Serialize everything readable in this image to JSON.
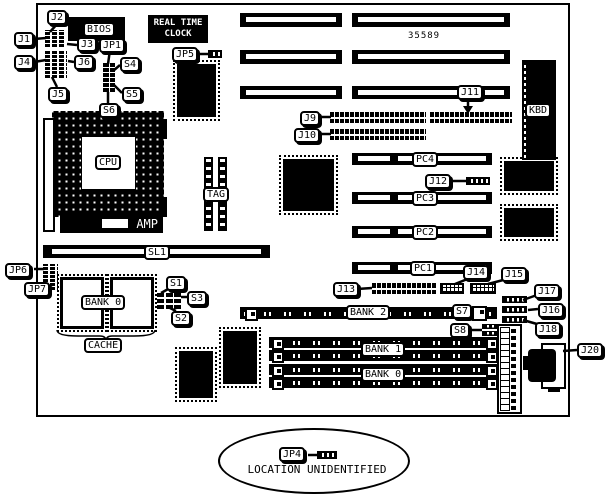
{
  "diagram": {
    "part_number": "35589",
    "rtc": {
      "line1": "REAL TIME",
      "line2": "CLOCK"
    },
    "amp_text": "AMP",
    "location_note": "LOCATION UNIDENTIFIED",
    "colors": {
      "ink": "#000000",
      "paper": "#ffffff"
    }
  },
  "labels": {
    "callouts": [
      {
        "id": "callout-j2",
        "text": "J2",
        "x": 47,
        "y": 10
      },
      {
        "id": "callout-j1",
        "text": "J1",
        "x": 14,
        "y": 32
      },
      {
        "id": "callout-j4",
        "text": "J4",
        "x": 14,
        "y": 55
      },
      {
        "id": "callout-j5",
        "text": "J5",
        "x": 48,
        "y": 87
      },
      {
        "id": "callout-j3",
        "text": "J3",
        "x": 77,
        "y": 37
      },
      {
        "id": "callout-jp1",
        "text": "JP1",
        "x": 99,
        "y": 38
      },
      {
        "id": "callout-j6",
        "text": "J6",
        "x": 74,
        "y": 55
      },
      {
        "id": "callout-s4",
        "text": "S4",
        "x": 120,
        "y": 57
      },
      {
        "id": "callout-s5",
        "text": "S5",
        "x": 122,
        "y": 87
      },
      {
        "id": "callout-s6",
        "text": "S6",
        "x": 99,
        "y": 103
      },
      {
        "id": "callout-jp5",
        "text": "JP5",
        "x": 172,
        "y": 47
      },
      {
        "id": "callout-j9",
        "text": "J9",
        "x": 300,
        "y": 111
      },
      {
        "id": "callout-j10",
        "text": "J10",
        "x": 294,
        "y": 128
      },
      {
        "id": "callout-j11",
        "text": "J11",
        "x": 457,
        "y": 85
      },
      {
        "id": "callout-j12",
        "text": "J12",
        "x": 425,
        "y": 174
      },
      {
        "id": "callout-jp6",
        "text": "JP6",
        "x": 5,
        "y": 263
      },
      {
        "id": "callout-jp7",
        "text": "JP7",
        "x": 24,
        "y": 282
      },
      {
        "id": "callout-s1",
        "text": "S1",
        "x": 166,
        "y": 276
      },
      {
        "id": "callout-s3",
        "text": "S3",
        "x": 187,
        "y": 291
      },
      {
        "id": "callout-s2",
        "text": "S2",
        "x": 171,
        "y": 311
      },
      {
        "id": "callout-j13",
        "text": "J13",
        "x": 333,
        "y": 282
      },
      {
        "id": "callout-j14",
        "text": "J14",
        "x": 463,
        "y": 265
      },
      {
        "id": "callout-j15",
        "text": "J15",
        "x": 501,
        "y": 267
      },
      {
        "id": "callout-j17",
        "text": "J17",
        "x": 534,
        "y": 284
      },
      {
        "id": "callout-j16",
        "text": "J16",
        "x": 538,
        "y": 303
      },
      {
        "id": "callout-j18",
        "text": "J18",
        "x": 535,
        "y": 322
      },
      {
        "id": "callout-s7",
        "text": "S7",
        "x": 452,
        "y": 304
      },
      {
        "id": "callout-s8",
        "text": "S8",
        "x": 450,
        "y": 323
      },
      {
        "id": "callout-j20",
        "text": "J20",
        "x": 577,
        "y": 343
      },
      {
        "id": "callout-jp4",
        "text": "JP4",
        "x": 279,
        "y": 447
      }
    ],
    "parts": [
      {
        "id": "label-bios",
        "text": "BIOS",
        "x": 83,
        "y": 22
      },
      {
        "id": "label-cpu",
        "text": "CPU",
        "x": 95,
        "y": 155
      },
      {
        "id": "label-tag",
        "text": "TAG",
        "x": 203,
        "y": 187
      },
      {
        "id": "label-sl1",
        "text": "SL1",
        "x": 144,
        "y": 245
      },
      {
        "id": "label-kbd",
        "text": "KBD",
        "x": 525,
        "y": 103
      },
      {
        "id": "label-pc4",
        "text": "PC4",
        "x": 412,
        "y": 152
      },
      {
        "id": "label-pc3",
        "text": "PC3",
        "x": 412,
        "y": 191
      },
      {
        "id": "label-pc2",
        "text": "PC2",
        "x": 412,
        "y": 225
      },
      {
        "id": "label-pc1",
        "text": "PC1",
        "x": 410,
        "y": 261
      },
      {
        "id": "label-bank2",
        "text": "BANK 2",
        "x": 346,
        "y": 305
      },
      {
        "id": "label-bank1",
        "text": "BANK 1",
        "x": 361,
        "y": 342
      },
      {
        "id": "label-bank0-simm",
        "text": "BANK 0",
        "x": 361,
        "y": 367
      },
      {
        "id": "label-bank0-cache",
        "text": "BANK 0",
        "x": 81,
        "y": 295
      },
      {
        "id": "label-cache",
        "text": "CACHE",
        "x": 84,
        "y": 338
      }
    ]
  }
}
